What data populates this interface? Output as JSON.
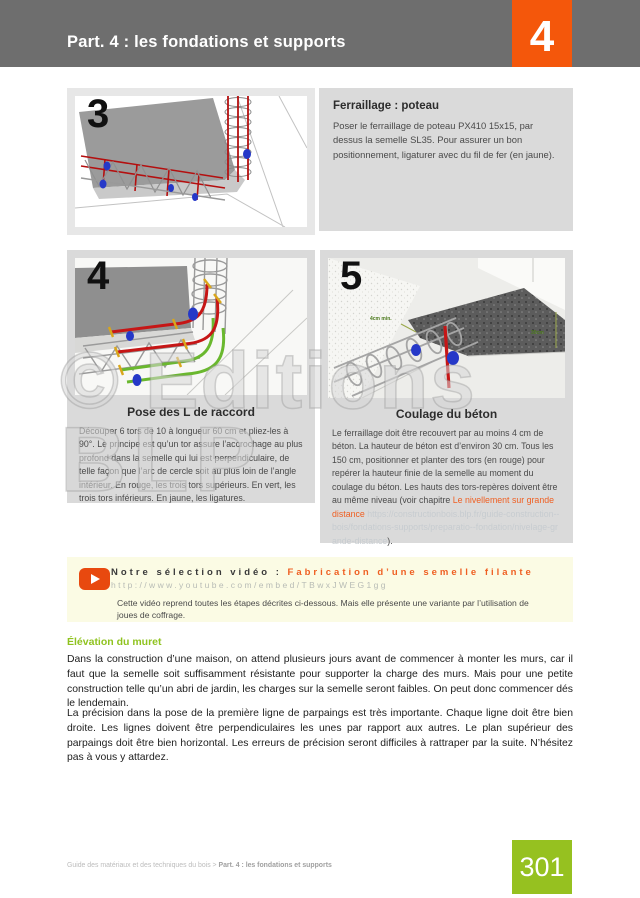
{
  "header": {
    "title": "Part. 4 : les fondations et supports",
    "part_number": "4"
  },
  "steps": [
    {
      "number": "3",
      "heading": "Ferraillage : poteau",
      "body": "Poser le ferraillage de poteau PX410 15x15, par dessus la semelle SL35. Pour assurer un bon positionnement, ligaturer avec du fil de fer (en jaune)."
    },
    {
      "number": "4",
      "caption": "Pose des L de raccord",
      "body": "Découper 6 tors de 10 à longueur 60 cm et pliez-les à 90°. Le principe est qu’un tor assure l’accrochage au plus profond dans la semelle qui lui est perpendiculaire, de telle façon que l’arc de cercle soit au plus loin de l’angle intérieur. En rouge, les trois tors supérieurs. En vert, les trois tors inférieurs. En jaune, les ligatures."
    },
    {
      "number": "5",
      "caption": "Coulage du béton",
      "body_before_link": "Le ferraillage doit être recouvert par au moins 4 cm de béton. La hauteur de béton est d’environ 30 cm. Tous les 150 cm, positionner et planter des tors (en rouge) pour repérer la hauteur finie de la semelle au moment du coulage du béton. Les hauts des tors-repères doivent être au même niveau (voir chapitre ",
      "link_text": "Le nivellement sur grande distance",
      "link_url_shown": " https://constructionbois.blp.fr/guide-construction--bois/fondations-supports/preparatio--fondation/nivelage-grande-distance",
      "body_after_link": ").",
      "annotations": {
        "cover_min": "4cm min.",
        "height": "30cm"
      }
    }
  ],
  "video": {
    "label": "Notre sélection vidéo :",
    "title": "Fabrication d’une semelle filante",
    "url": "http://www.youtube.com/embed/TBwxJWEG1gg",
    "description": "Cette vidéo reprend toutes les étapes décrites ci-dessous. Mais elle présente une variante par l’utilisation de joues de coffrage.",
    "icon": "youtube-play-icon"
  },
  "section": {
    "heading": "Élévation du muret",
    "paragraph1": "Dans la construction d’une maison, on attend plusieurs jours avant de commencer à monter les murs, car il faut que la semelle soit suffisamment résistante pour supporter la charge des murs. Mais pour une petite construction telle qu’un abri de jardin, les charges sur la semelle seront faibles. On peut donc commencer dés le lendemain.",
    "paragraph2": "La précision dans la pose de la première ligne de parpaings est très importante. Chaque ligne doit être bien droite. Les lignes doivent être perpendiculaires les unes par rapport aux autres. Le plan supérieur des parpaings doit être bien horizontal. Les erreurs de précision seront difficiles à rattraper par la suite. N’hésitez pas à vous y attardez."
  },
  "footer": {
    "breadcrumb_plain": "Guide des matériaux et des techniques du bois > ",
    "breadcrumb_bold": "Part. 4 : les fondations et supports",
    "page_number": "301"
  },
  "watermark": {
    "line1": "© Editions",
    "line2": "BLP"
  },
  "colors": {
    "header_gray": "#6e6e6e",
    "accent_orange": "#f4570b",
    "link_orange": "#ef5f22",
    "accent_green": "#96c120",
    "panel_gray": "#dadada",
    "video_bg": "#fbfbe4"
  }
}
